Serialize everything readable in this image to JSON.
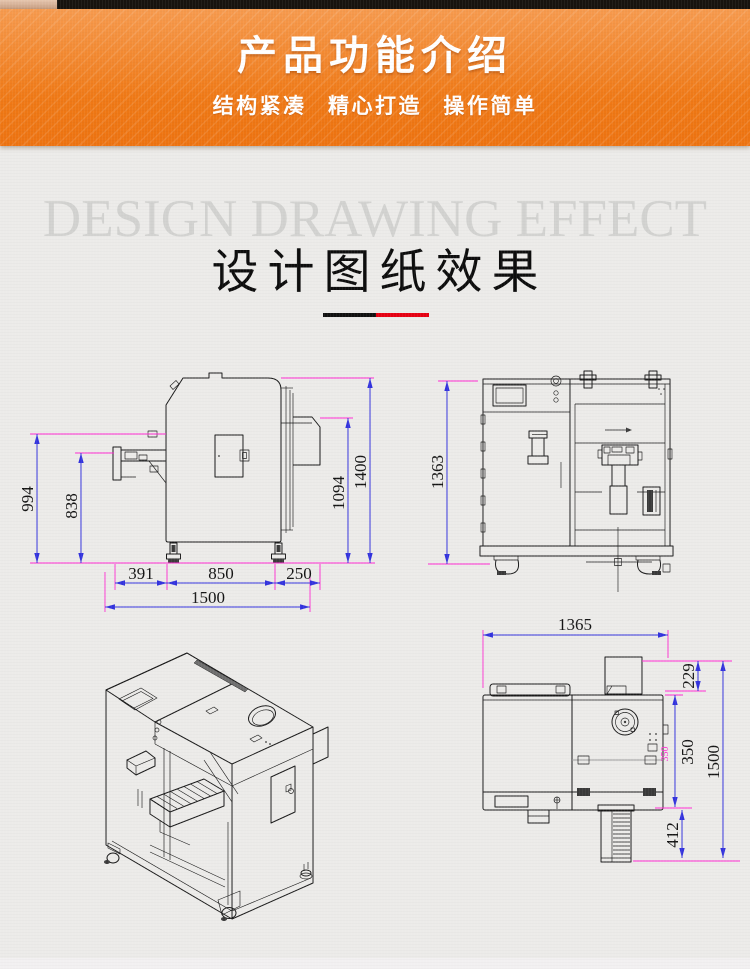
{
  "banner": {
    "title": "产品功能介绍",
    "subtitle": "结构紧凑 精心打造 操作简单",
    "colors": {
      "top": "#f69a4e",
      "bottom": "#ef7916"
    }
  },
  "section": {
    "watermark": "DESIGN DRAWING EFFECT",
    "title": "设计图纸效果",
    "divider": {
      "black": "#111111",
      "red": "#e60012"
    }
  },
  "drawing_colors": {
    "line": "#1a1a1a",
    "dimension_line": "#3333dd",
    "extension_line": "#ff2ad2",
    "dim_text": "#141414"
  },
  "views": {
    "side_view": {
      "dims": {
        "left_outer": "994",
        "left_inner": "838",
        "bottom_1": "391",
        "bottom_2": "850",
        "bottom_3": "250",
        "bottom_total": "1500",
        "right_inner": "1094",
        "right_outer": "1400"
      }
    },
    "front_view": {
      "dims": {
        "height": "1363"
      }
    },
    "top_view": {
      "dims": {
        "width": "1365",
        "chute_depth": "229",
        "inner_depth": "350",
        "inner_depth_marker": "350",
        "total_depth": "1500",
        "conveyor_length": "412"
      }
    }
  }
}
